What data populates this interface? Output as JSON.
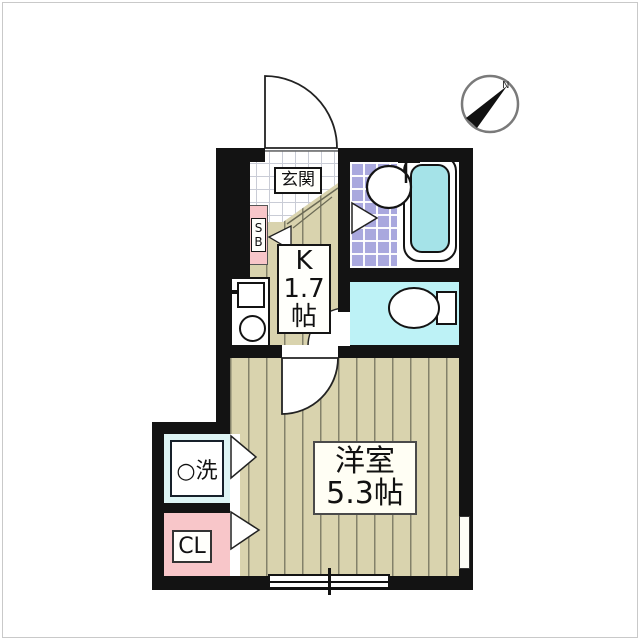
{
  "compass": {
    "north_label": "N"
  },
  "rooms": {
    "entrance": {
      "label": "玄関"
    },
    "shoe_box": {
      "label_lines": [
        "S",
        "B"
      ]
    },
    "kitchen": {
      "label_lines": [
        "K",
        "1.7",
        "帖"
      ]
    },
    "western_room": {
      "label_lines": [
        "洋室",
        "5.3帖"
      ]
    },
    "washer": {
      "label": "○洗"
    },
    "closet": {
      "label": "CL"
    }
  },
  "colors": {
    "wall": "#131313",
    "wood_floor": "#d9d3ae",
    "wood_floor_stripe": "#83816a",
    "entrance_tile": "#ffffff",
    "entrance_tile_grid": "#c9ccd6",
    "bathroom_tile": "#a9a8de",
    "bathtub_water": "#a5e3e8",
    "toilet_floor": "#bdf2f6",
    "washer_floor": "#def5f5",
    "closet_pink": "#f8c6c9",
    "shoe_box_pink": "#f8c6c9",
    "label_background": "#fffffb"
  }
}
